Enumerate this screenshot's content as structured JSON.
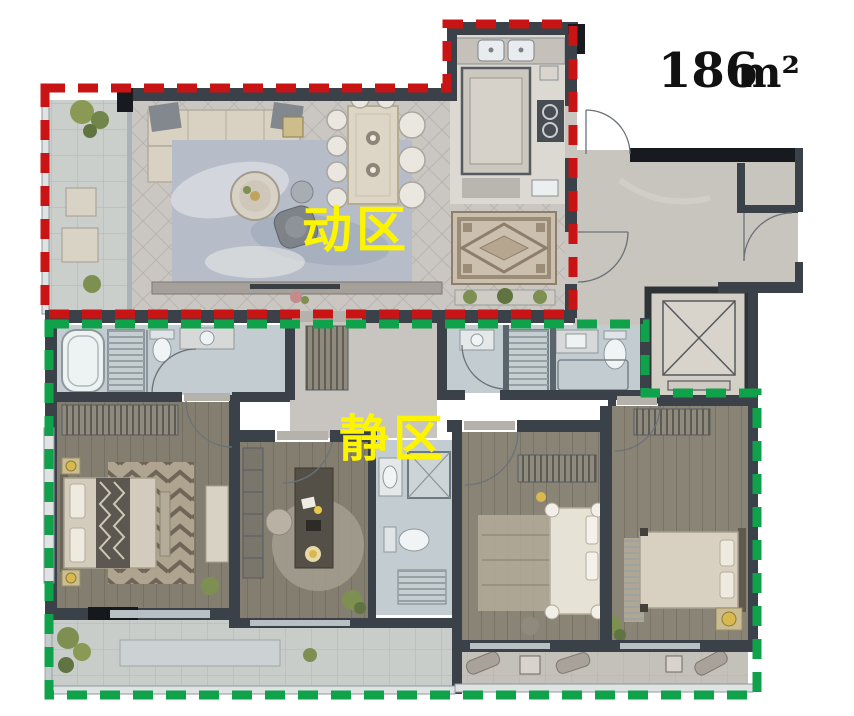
{
  "page": {
    "background_color": "#ffffff"
  },
  "floor_plan": {
    "area_label": {
      "value": "186",
      "unit": "m²"
    },
    "zones": {
      "active": {
        "label": "动区",
        "outline_color": "#c81414",
        "label_color": "#fdf400"
      },
      "quiet": {
        "label": "静区",
        "outline_color": "#0fa24a",
        "label_color": "#fdf400"
      }
    }
  }
}
